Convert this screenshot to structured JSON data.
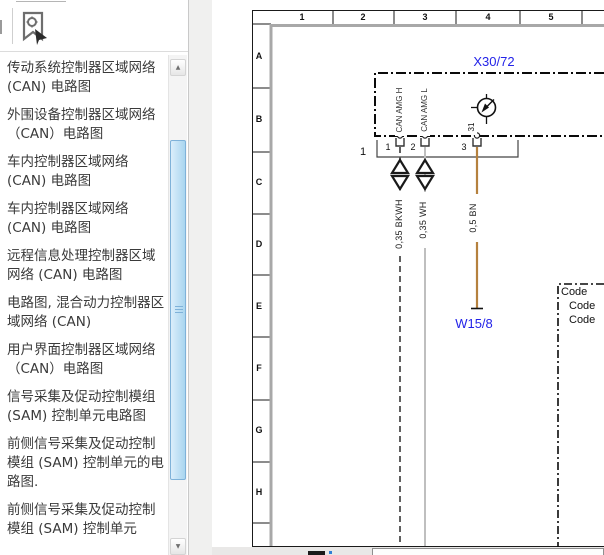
{
  "sidebar": {
    "toolbar": {
      "bookmark_button": "bookmark-zoom"
    },
    "items": [
      "传动系统控制器区域网络 (CAN) 电路图",
      "外围设备控制器区域网络（CAN）电路图",
      "车内控制器区域网络 (CAN) 电路图",
      "车内控制器区域网络 (CAN) 电路图",
      "远程信息处理控制器区域网络 (CAN) 电路图",
      "电路图, 混合动力控制器区域网络 (CAN)",
      "用户界面控制器区域网络（CAN）电路图",
      "信号采集及促动控制模组 (SAM) 控制单元电路图",
      "前侧信号采集及促动控制模组 (SAM) 控制单元的电路图.",
      "前侧信号采集及促动控制模组 (SAM) 控制单元"
    ],
    "scrollbar": {
      "up_glyph": "▲",
      "down_glyph": "▼"
    }
  },
  "gutter": {
    "collapse_glyph": ""
  },
  "diagram": {
    "grid": {
      "columns": [
        "1",
        "2",
        "3",
        "4",
        "5"
      ],
      "rows": [
        "A",
        "B",
        "C",
        "D",
        "E",
        "F",
        "G",
        "H"
      ]
    },
    "connector": {
      "id": "X30/72",
      "plug": "1",
      "pins": [
        "1",
        "2",
        "3"
      ],
      "pin3_circuit": "31",
      "signals": [
        "CAN AMG H",
        "CAN AMG L"
      ]
    },
    "wires": [
      {
        "label": "0,35 BKWH",
        "color": "#4f4f4f",
        "style": "dashed"
      },
      {
        "label": "0,35 WH",
        "color": "#bfbfbf",
        "style": "solid"
      },
      {
        "label": "0,5 BN",
        "color": "#b5813e",
        "style": "solid"
      }
    ],
    "ground": {
      "id": "W15/8"
    },
    "code_box": {
      "lines": [
        "Code",
        "Code",
        "Code"
      ]
    },
    "colors": {
      "ref_label_blue": "#2323e8",
      "frame_gray": "#a8a8a8"
    }
  }
}
